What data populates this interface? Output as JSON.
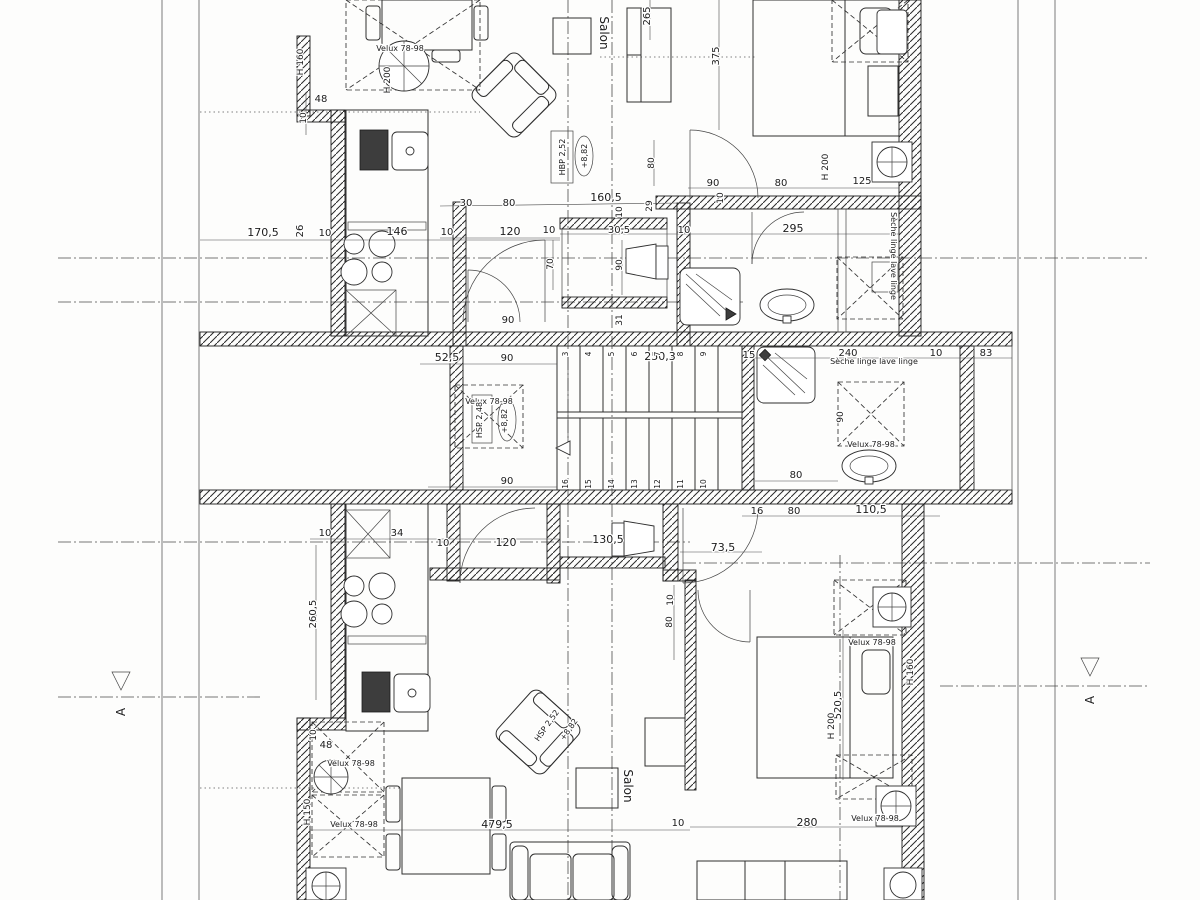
{
  "labels": {
    "salon_top": "Salon",
    "salon_bottom": "Salon",
    "section_left": "A",
    "section_right": "A",
    "velux": "Velux 78-98",
    "seche": "Sèche linge lave linge",
    "hbp_top": "HBP 2,52",
    "elev": "+8,82",
    "hsp_mid": "HSP 2,48",
    "hsp_bot": "HSP 2,52",
    "h160": "H 160",
    "h200": "H 200",
    "h150": "H 150"
  },
  "stairs": {
    "dim": "250,3",
    "top": [
      "3",
      "4",
      "5",
      "6",
      "7",
      "8",
      "9"
    ],
    "bottom": [
      "16",
      "15",
      "14",
      "13",
      "12",
      "11",
      "10"
    ]
  },
  "dims": {
    "top": {
      "w170_5": "170,5",
      "w26": "26",
      "w10a": "10",
      "w146": "146",
      "w10b": "10",
      "w120": "120",
      "w10c": "10",
      "w70": "70",
      "w48": "48",
      "w10d": "10",
      "w265": "265",
      "w375": "375",
      "w30": "30",
      "w80a": "80",
      "w160_5": "160,5",
      "w10e": "10",
      "w29": "29",
      "w80v": "80",
      "w90a": "90",
      "w10f": "10",
      "w80b": "80",
      "w125": "125",
      "w30_5": "30,5",
      "w10g": "10",
      "w295": "295",
      "w90wc": "90",
      "w31": "31",
      "w90door": "90"
    },
    "mid": {
      "m52_5": "52,5",
      "m90a": "90",
      "m90b": "90",
      "m15": "15",
      "m240": "240",
      "m10a": "10",
      "m83": "83",
      "m90v": "90",
      "m80a": "80",
      "m16": "16",
      "m80b": "80",
      "m110_5": "110,5"
    },
    "bot": {
      "b10a": "10",
      "b34": "34",
      "b10b": "10",
      "b120": "120",
      "b130_5": "130,5",
      "b73_5": "73,5",
      "b260_5": "260,5",
      "b10v": "10",
      "b80v": "80",
      "b48": "48",
      "b10c": "10",
      "b479_5": "479,5",
      "b10d": "10",
      "b280": "280",
      "b520_5": "520,5"
    }
  }
}
